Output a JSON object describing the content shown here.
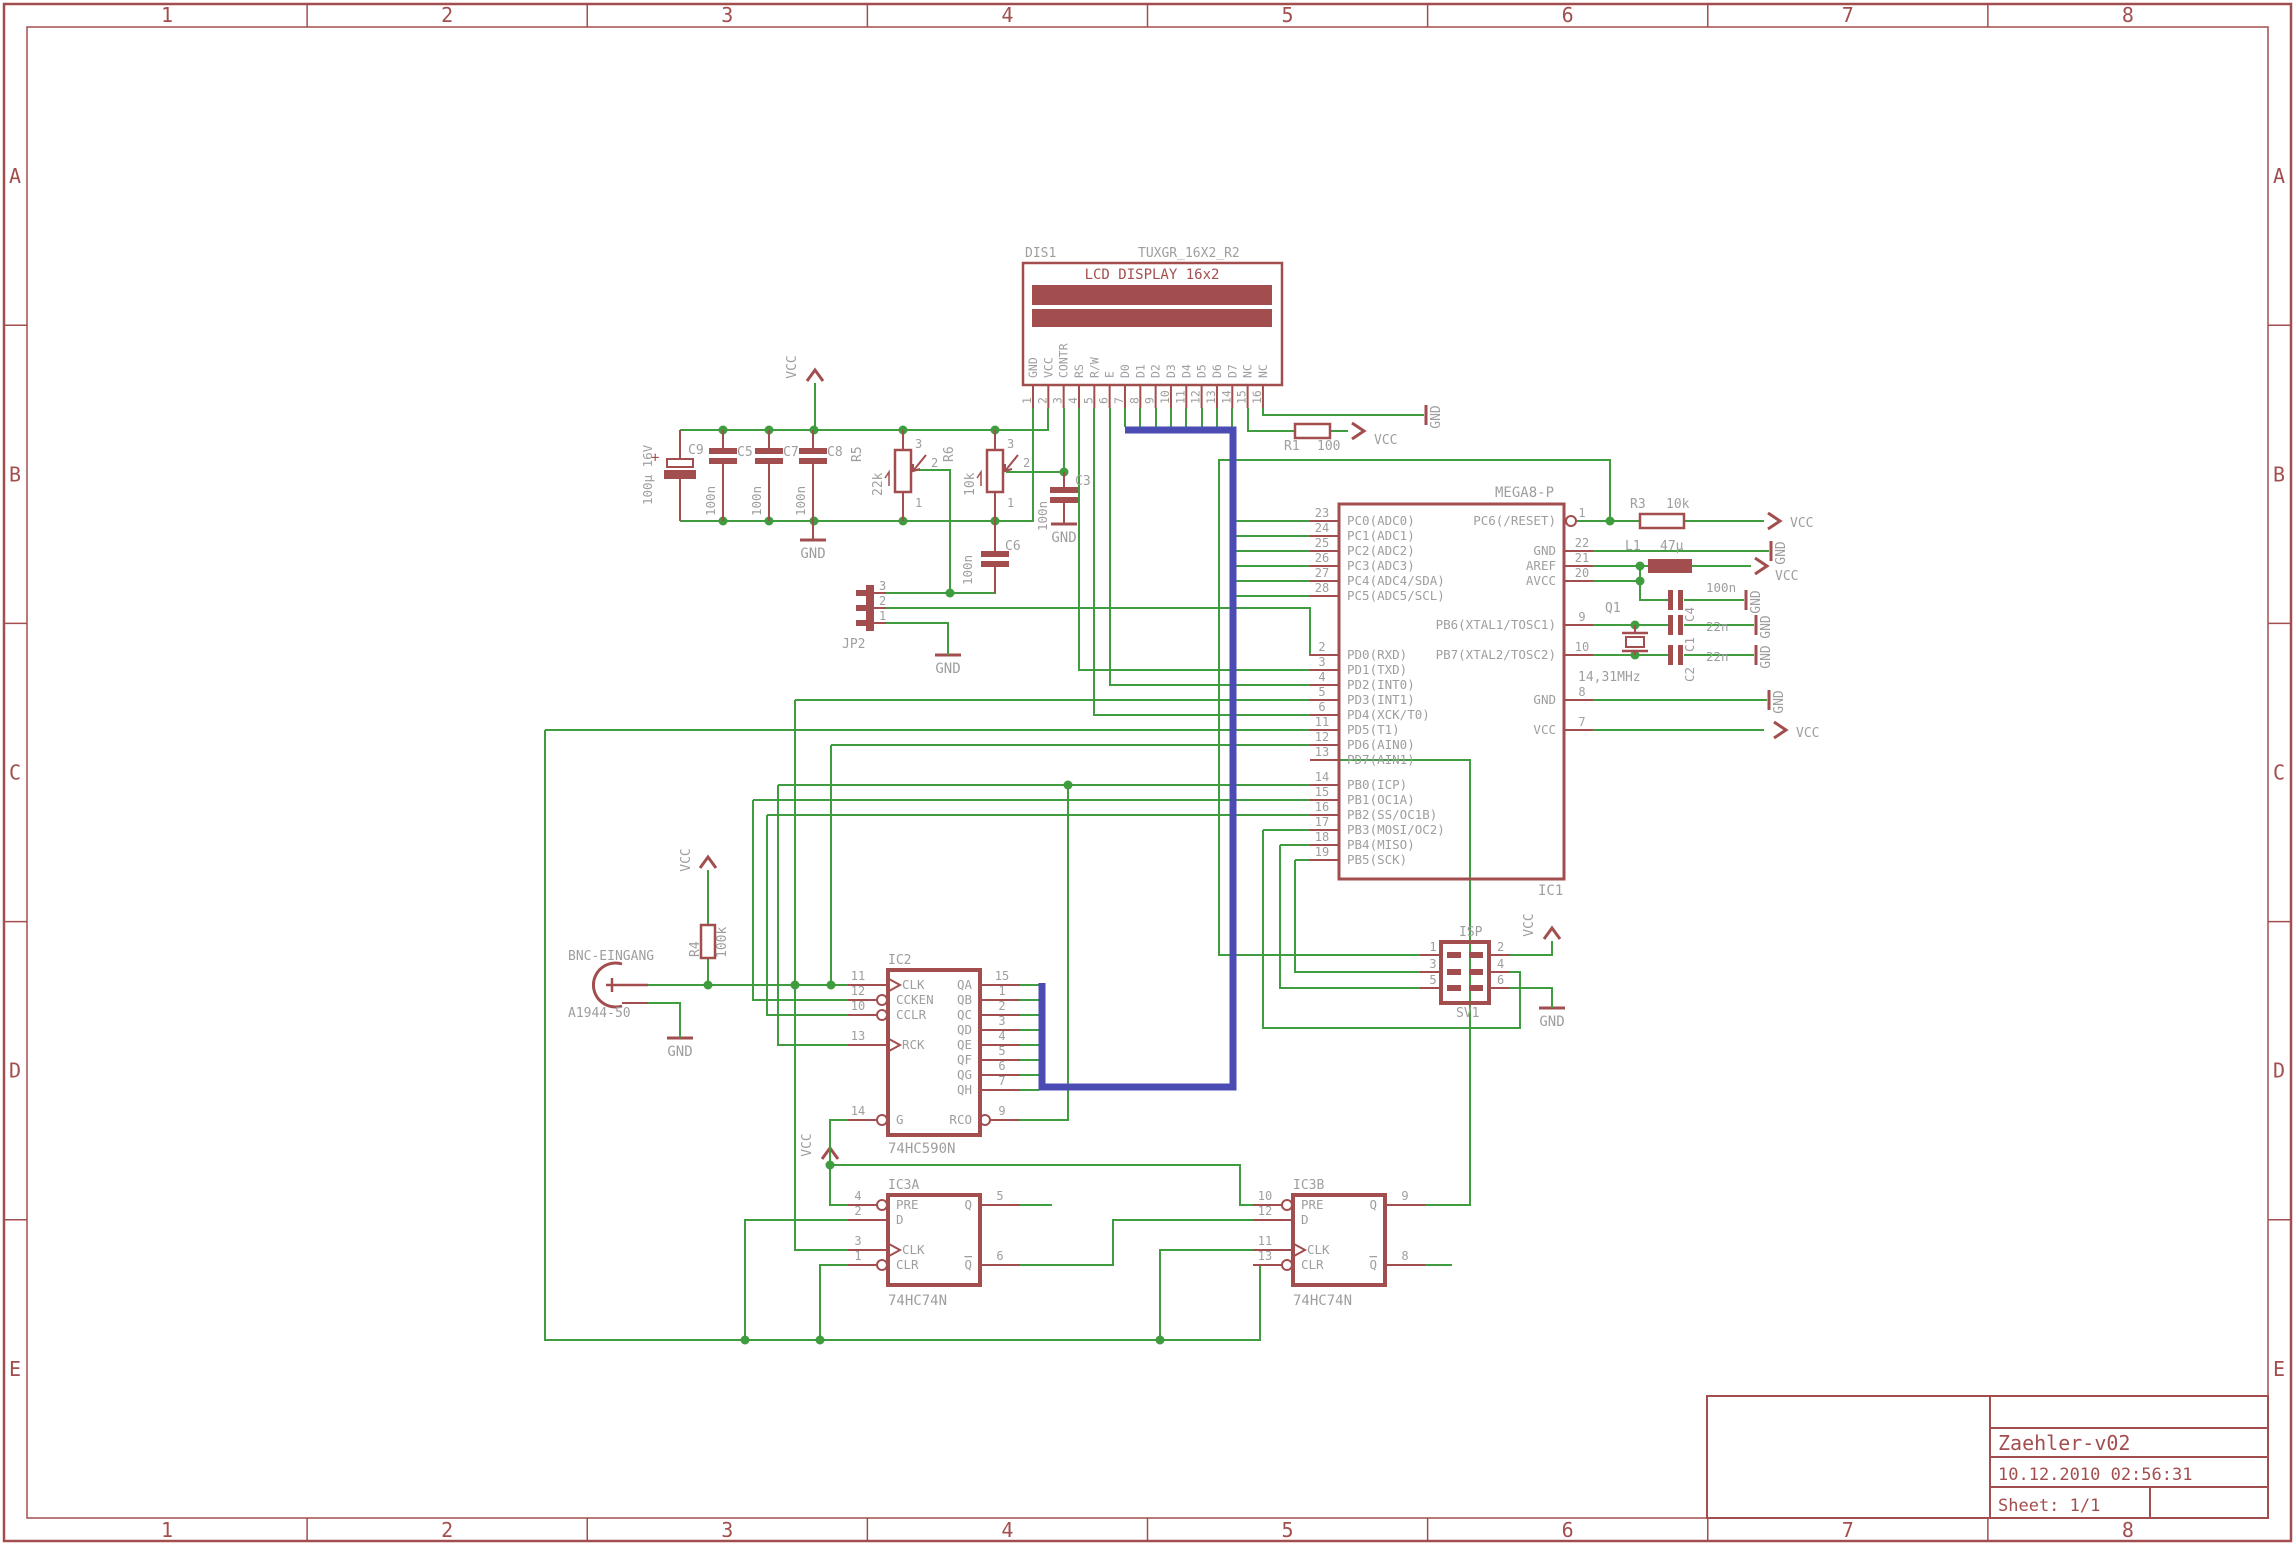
{
  "schematic": {
    "colors": {
      "symbol": "#A34E4E",
      "wire": "#3F9C3F",
      "bus": "#4B4BB4",
      "label": "#9E9E9E",
      "background": "#FFFFFF"
    },
    "frame": {
      "columns": [
        "1",
        "2",
        "3",
        "4",
        "5",
        "6",
        "7",
        "8"
      ],
      "rows": [
        "A",
        "B",
        "C",
        "D",
        "E"
      ]
    },
    "title_block": {
      "title": "Zaehler-v02",
      "timestamp": "10.12.2010 02:56:31",
      "sheet_label": "Sheet: 1/1"
    },
    "power": {
      "vcc": "VCC",
      "gnd": "GND"
    },
    "display": {
      "ref": "DIS1",
      "part": "TUXGR_16X2_R2",
      "title": "LCD DISPLAY 16x2",
      "pins": [
        {
          "n": "1",
          "name": "GND"
        },
        {
          "n": "2",
          "name": "VCC"
        },
        {
          "n": "3",
          "name": "CONTR"
        },
        {
          "n": "4",
          "name": "RS"
        },
        {
          "n": "5",
          "name": "R/W"
        },
        {
          "n": "6",
          "name": "E"
        },
        {
          "n": "7",
          "name": "D0"
        },
        {
          "n": "8",
          "name": "D1"
        },
        {
          "n": "9",
          "name": "D2"
        },
        {
          "n": "10",
          "name": "D3"
        },
        {
          "n": "11",
          "name": "D4"
        },
        {
          "n": "12",
          "name": "D5"
        },
        {
          "n": "13",
          "name": "D6"
        },
        {
          "n": "14",
          "name": "D7"
        },
        {
          "n": "15",
          "name": "NC"
        },
        {
          "n": "16",
          "name": "NC"
        }
      ]
    },
    "mcu": {
      "ref": "IC1",
      "part": "MEGA8-P",
      "left_pins": [
        {
          "n": "23",
          "name": "PC0(ADC0)"
        },
        {
          "n": "24",
          "name": "PC1(ADC1)"
        },
        {
          "n": "25",
          "name": "PC2(ADC2)"
        },
        {
          "n": "26",
          "name": "PC3(ADC3)"
        },
        {
          "n": "27",
          "name": "PC4(ADC4/SDA)"
        },
        {
          "n": "28",
          "name": "PC5(ADC5/SCL)"
        },
        {
          "n": "2",
          "name": "PD0(RXD)"
        },
        {
          "n": "3",
          "name": "PD1(TXD)"
        },
        {
          "n": "4",
          "name": "PD2(INT0)"
        },
        {
          "n": "5",
          "name": "PD3(INT1)"
        },
        {
          "n": "6",
          "name": "PD4(XCK/T0)"
        },
        {
          "n": "11",
          "name": "PD5(T1)"
        },
        {
          "n": "12",
          "name": "PD6(AIN0)"
        },
        {
          "n": "13",
          "name": "PD7(AIN1)"
        },
        {
          "n": "14",
          "name": "PB0(ICP)"
        },
        {
          "n": "15",
          "name": "PB1(OC1A)"
        },
        {
          "n": "16",
          "name": "PB2(SS/OC1B)"
        },
        {
          "n": "17",
          "name": "PB3(MOSI/OC2)"
        },
        {
          "n": "18",
          "name": "PB4(MISO)"
        },
        {
          "n": "19",
          "name": "PB5(SCK)"
        }
      ],
      "right_pins": [
        {
          "n": "1",
          "name": "PC6(/RESET)"
        },
        {
          "n": "22",
          "name": "GND"
        },
        {
          "n": "21",
          "name": "AREF"
        },
        {
          "n": "20",
          "name": "AVCC"
        },
        {
          "n": "9",
          "name": "PB6(XTAL1/TOSC1)"
        },
        {
          "n": "10",
          "name": "PB7(XTAL2/TOSC2)"
        },
        {
          "n": "8",
          "name": "GND"
        },
        {
          "n": "7",
          "name": "VCC"
        }
      ]
    },
    "counter": {
      "ref": "IC2",
      "part": "74HC590N",
      "left_pins": [
        {
          "n": "11",
          "name": "CLK"
        },
        {
          "n": "12",
          "name": "CCKEN"
        },
        {
          "n": "10",
          "name": "CCLR"
        },
        {
          "n": "13",
          "name": "RCK"
        },
        {
          "n": "14",
          "name": "G"
        }
      ],
      "right_pins": [
        {
          "n": "15",
          "name": "QA"
        },
        {
          "n": "1",
          "name": "QB"
        },
        {
          "n": "2",
          "name": "QC"
        },
        {
          "n": "3",
          "name": "QD"
        },
        {
          "n": "4",
          "name": "QE"
        },
        {
          "n": "5",
          "name": "QF"
        },
        {
          "n": "6",
          "name": "QG"
        },
        {
          "n": "7",
          "name": "QH"
        },
        {
          "n": "9",
          "name": "RCO"
        }
      ]
    },
    "flipflop_a": {
      "ref": "IC3A",
      "part": "74HC74N",
      "left_pins": [
        {
          "n": "4",
          "name": "PRE"
        },
        {
          "n": "2",
          "name": "D"
        },
        {
          "n": "3",
          "name": "CLK"
        },
        {
          "n": "1",
          "name": "CLR"
        }
      ],
      "right_pins": [
        {
          "n": "5",
          "name": "Q"
        },
        {
          "n": "6",
          "name": "Q"
        }
      ]
    },
    "flipflop_b": {
      "ref": "IC3B",
      "part": "74HC74N",
      "left_pins": [
        {
          "n": "10",
          "name": "PRE"
        },
        {
          "n": "12",
          "name": "D"
        },
        {
          "n": "11",
          "name": "CLK"
        },
        {
          "n": "13",
          "name": "CLR"
        }
      ],
      "right_pins": [
        {
          "n": "9",
          "name": "Q"
        },
        {
          "n": "8",
          "name": "Q"
        }
      ]
    },
    "bnc": {
      "label": "BNC-EINGANG",
      "part": "A1944-50"
    },
    "isp": {
      "label": "ISP",
      "ref": "SV1",
      "pin_numbers_left": [
        "1",
        "3",
        "5"
      ],
      "pin_numbers_right": [
        "2",
        "4",
        "6"
      ]
    },
    "jumper": {
      "ref": "JP2",
      "pin_numbers": [
        "3",
        "2",
        "1"
      ]
    },
    "resistors": {
      "r1": {
        "ref": "R1",
        "value": "100"
      },
      "r3": {
        "ref": "R3",
        "value": "10k"
      },
      "r4": {
        "ref": "R4",
        "value": "100k"
      },
      "r5": {
        "ref": "R5",
        "value": "22k"
      },
      "r6": {
        "ref": "R6",
        "value": "10k"
      }
    },
    "pot_pin_numbers": [
      "3",
      "2",
      "1"
    ],
    "capacitors": {
      "c1": {
        "ref": "C1",
        "value": "22n"
      },
      "c2": {
        "ref": "C2",
        "value": "22n"
      },
      "c3": {
        "ref": "C3",
        "value": "100n"
      },
      "c4": {
        "ref": "C4",
        "value": "100n"
      },
      "c5": {
        "ref": "C5",
        "value": "100n"
      },
      "c6": {
        "ref": "C6",
        "value": "100n"
      },
      "c7": {
        "ref": "C7",
        "value": "100n"
      },
      "c8": {
        "ref": "C8",
        "value": "100n"
      },
      "c9": {
        "ref": "C9",
        "value": "100µ 16V",
        "polarity": "+"
      }
    },
    "inductor": {
      "ref": "L1",
      "value": "47µ"
    },
    "crystal": {
      "ref": "Q1",
      "value": "14,31MHz"
    }
  }
}
